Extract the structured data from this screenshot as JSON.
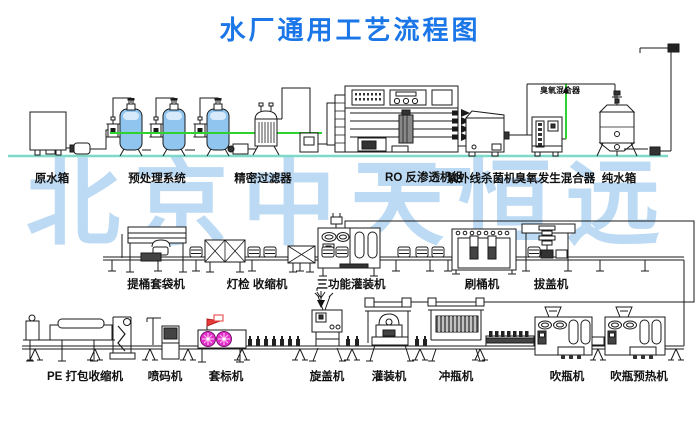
{
  "title": "水厂通用工艺流程图",
  "watermark": "北京中天恒远",
  "pipe_note": "臭氧混合器",
  "labels": {
    "top": [
      "原水箱",
      "预处理系统",
      "精密过滤器",
      "RO 反渗透机组",
      "紫外线杀菌机",
      "臭氧发生混合器",
      "纯水箱"
    ],
    "middle": [
      "提桶套袋机",
      "灯检 收缩机",
      "三功能灌装机",
      "刷桶机",
      "拔盖机"
    ],
    "bottom": [
      "PE 打包收缩机",
      "喷码机",
      "套标机",
      "旋盖机",
      "灌装机",
      "冲瓶机",
      "吹瓶机",
      "吹瓶预热机"
    ]
  },
  "colors": {
    "title": "#1b76e8",
    "watermark": "#b5d7f3",
    "ground": "#7fd9c8",
    "pipe_green": "#2fd32f",
    "tank_fill": "#8fc5ee",
    "label_highlight": "#bcd9f4",
    "star_pink": "#e130c9",
    "flag_red": "#e93a3a"
  }
}
